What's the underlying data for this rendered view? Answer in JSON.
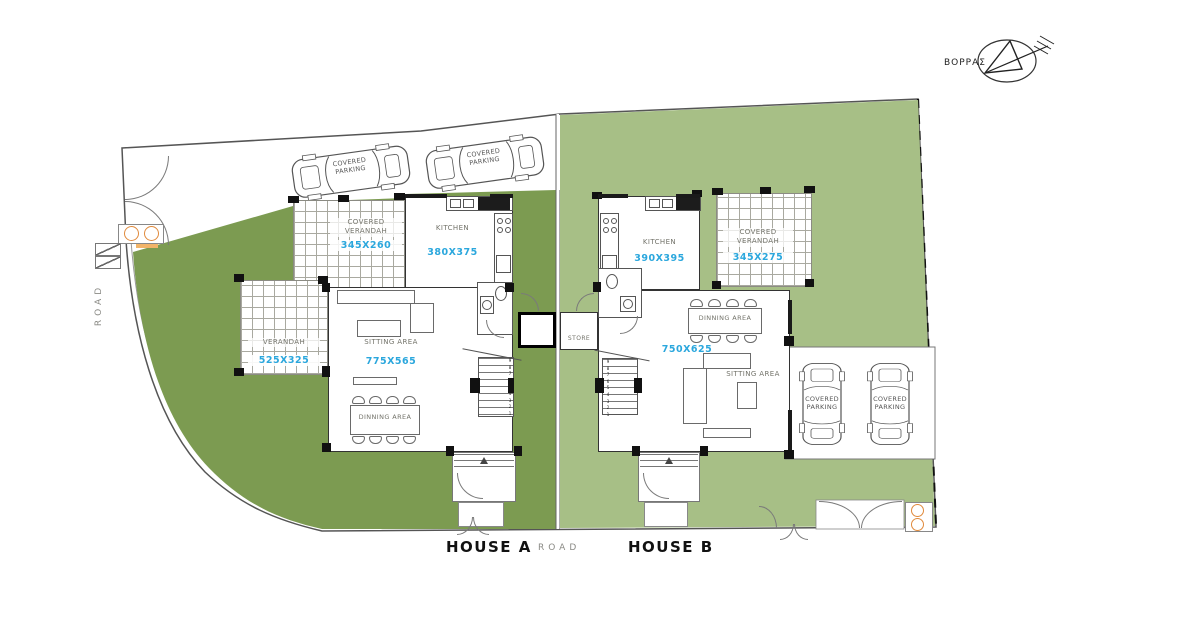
{
  "compass": {
    "label": "ΒΟΡΡΑΣ"
  },
  "site": {
    "road_left": "ROAD",
    "road_bottom": "ROAD",
    "store_label": "STORE",
    "colors": {
      "garden_house_a": "#7c9b51",
      "garden_house_b": "#a7bf86",
      "dimension_text": "#2ba7dd"
    }
  },
  "house_a": {
    "title": "HOUSE A",
    "parking1_label": "COVERED\nPARKING",
    "parking2_label": "COVERED\nPARKING",
    "covered_verandah": {
      "label": "COVERED\nVERANDAH",
      "dim": "345X260"
    },
    "kitchen": {
      "label": "KITCHEN",
      "dim": "380X375"
    },
    "verandah": {
      "label": "VERANDAH",
      "dim": "525X325"
    },
    "sitting": {
      "label": "SITTING AREA",
      "dim": "775X565"
    },
    "dinning": {
      "label": "DINNING AREA"
    },
    "stairs_numbers": "9\n8\n7\n6\n5\n4\n3\n2\n1"
  },
  "house_b": {
    "title": "HOUSE B",
    "kitchen": {
      "label": "KITCHEN",
      "dim": "390X395"
    },
    "covered_verandah": {
      "label": "COVERED\nVERANDAH",
      "dim": "345X275"
    },
    "dinning": {
      "label": "DINNING AREA"
    },
    "main_dim": "750X625",
    "sitting": {
      "label": "SITTING AREA"
    },
    "parking1_label": "COVERED\nPARKING",
    "parking2_label": "COVERED\nPARKING",
    "stairs_numbers": "9\n8\n7\n6\n5\n4\n3\n2\n1"
  }
}
